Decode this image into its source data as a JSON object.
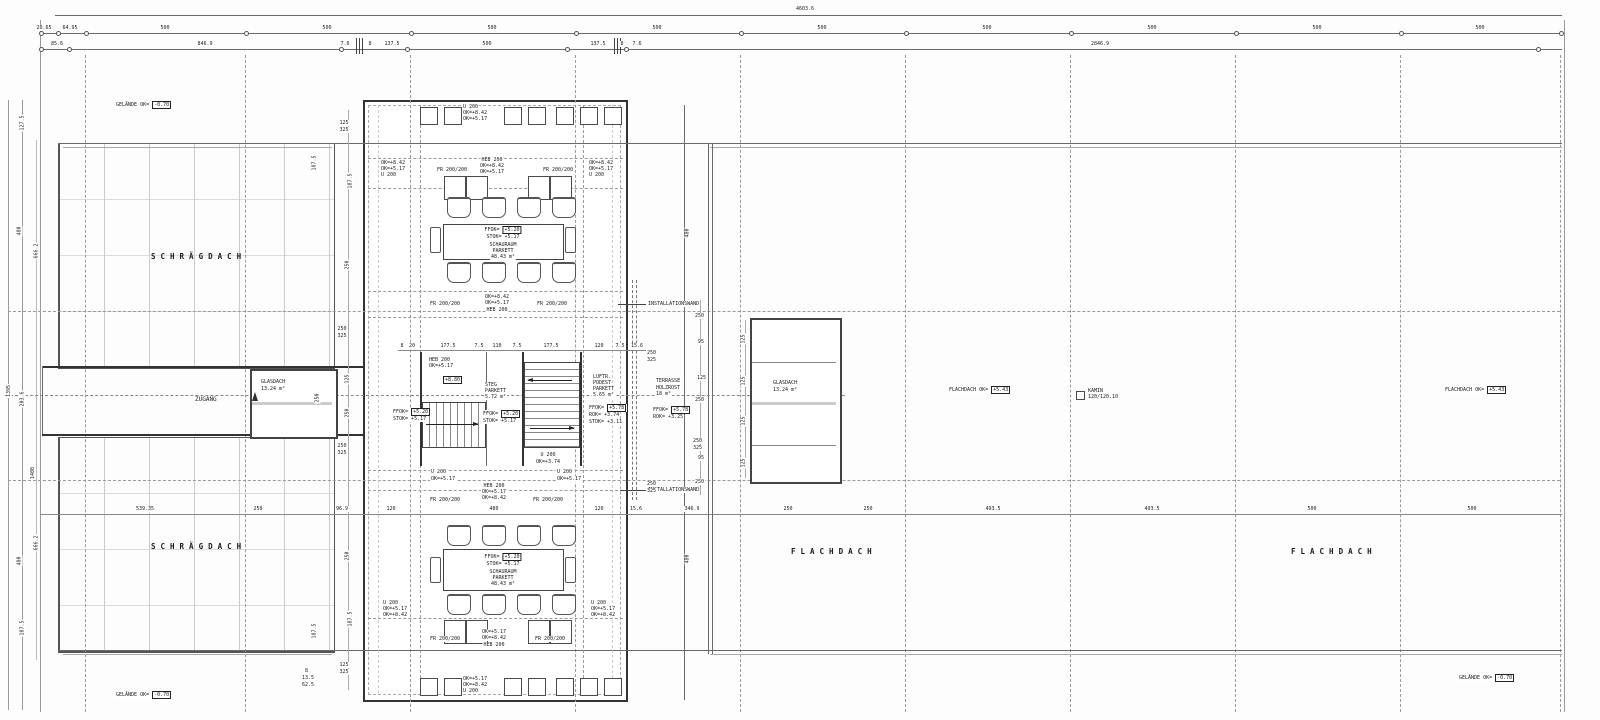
{
  "dims": {
    "overall_width": "4603.6",
    "top_row1": [
      "20.65",
      "64.95",
      "500",
      "500",
      "500",
      "500",
      "500",
      "500",
      "500",
      "500",
      "500"
    ],
    "top_row2": [
      "85.6",
      "846.9",
      "7.6",
      "8",
      "137.5",
      "500",
      "137.5",
      "8",
      "7.6",
      "2846.9"
    ],
    "mid_chain": [
      "539.35",
      "250",
      "96.9",
      "120",
      "480",
      "120",
      "15.6",
      "346.9",
      "250",
      "250",
      "493.5",
      "493.5",
      "500",
      "500"
    ],
    "stair_chain": [
      "8",
      "20",
      "177.5",
      "7.5",
      "110",
      "7.5",
      "177.5",
      "120",
      "7.5",
      "15.6"
    ],
    "left_chain": [
      "127.5",
      "480",
      "666.2",
      "1395",
      "203.6",
      "1400",
      "666.2",
      "480",
      "187.5"
    ],
    "pav_left_chain": [
      "125",
      "325",
      "187.5",
      "250",
      "250",
      "325",
      "125",
      "250",
      "250",
      "325",
      "250",
      "187.5",
      "125",
      "325"
    ],
    "pav_right_chain": [
      "480",
      "250",
      "95",
      "125",
      "250",
      "250",
      "325",
      "95",
      "250",
      "480"
    ],
    "terrace_chain": [
      "250",
      "325",
      "250",
      "325"
    ],
    "glas_chain": [
      "125",
      "125",
      "125",
      "125"
    ],
    "corner_stack": [
      "8",
      "13.5",
      "62.5"
    ],
    "glasdach_left_width": "250"
  },
  "levels": {
    "gelaende_label": "GELÄNDE OK=",
    "gelaende_value": "-0.70",
    "flachdach_label": "FLACHDACH OK=",
    "flachdach_value": "+5.43",
    "ffok_label": "FFOK=",
    "ffok_520": "+5.20",
    "stok_517": "STOK= +5.17",
    "ffok_578": "+5.78",
    "rok_374": "ROK= +3.74",
    "stok_311": "STOK= +3.11",
    "rok_325": "ROK= +3.25",
    "plus_880": "+8.80"
  },
  "notes": {
    "u200": "U 200",
    "heb200": "HEB 200",
    "fr200": "FR 200/200",
    "ok_842": "OK=+8.42",
    "ok_517": "OK=+5.17",
    "ok_374": "OK=+3.74",
    "installationswand": "INSTALLATIONSWAND"
  },
  "rooms": {
    "schraegdach": "SCHRÄGDACH",
    "flachdach": "FLACHDACH",
    "zugang": "ZUGANG",
    "glasdach": "GLASDACH",
    "glasdach_area": "13.24 m²",
    "schauraum": "SCHAURAUM",
    "parkett": "PARKETT",
    "schauraum_area": "48.43 m²",
    "steg": "STEG",
    "steg_area": "5.72 m²",
    "luftr_1": "LUFTR.",
    "luftr_2": "PODEST",
    "luftr_area": "5.65 m²",
    "terrasse": "TERRASSE",
    "holzrost": "HOLZROST",
    "terrasse_area": "18 m²",
    "kamin": "KAMIN",
    "kamin_size": "120/120.10"
  }
}
